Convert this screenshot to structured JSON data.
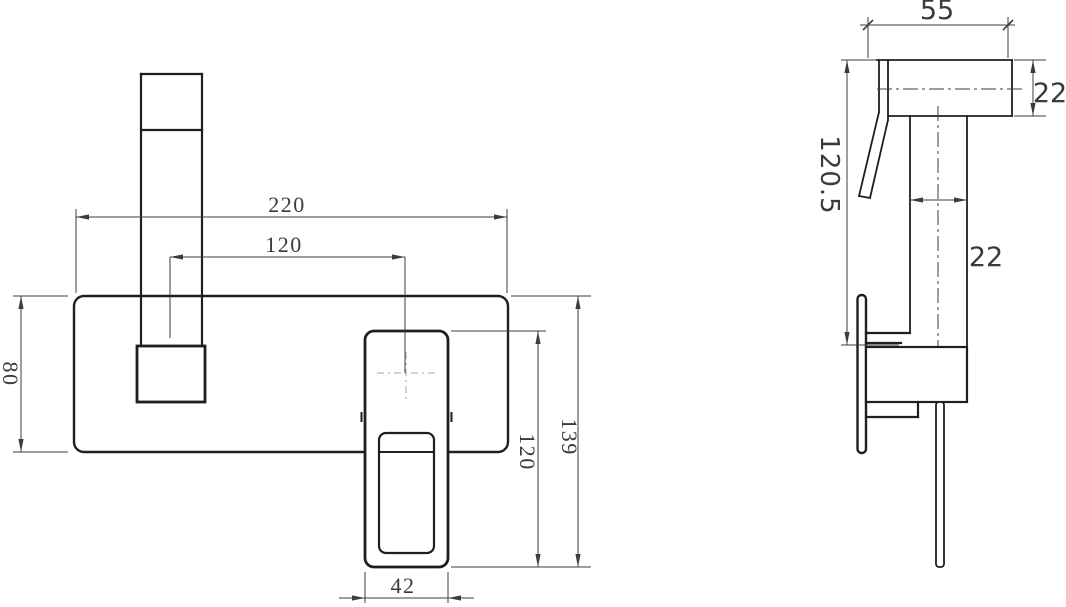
{
  "drawing": {
    "title": "wall-mounted-basin-mixer-dimension-drawing",
    "front_view": {
      "dims": {
        "plate_width": "220",
        "spout_to_handle": "120",
        "plate_height": "80",
        "handle_height": "120",
        "overall_height": "139",
        "handle_width": "42"
      }
    },
    "side_view": {
      "dims": {
        "spout_reach": "55",
        "spout_height": "22",
        "spout_tube_width": "22",
        "mount_depth": "120.5"
      }
    },
    "colors": {
      "line": "#1f1f1f",
      "dim": "#3d3d3d",
      "accent": "#c9b49a",
      "text": "#3a3a3a",
      "bg": "#ffffff"
    }
  }
}
